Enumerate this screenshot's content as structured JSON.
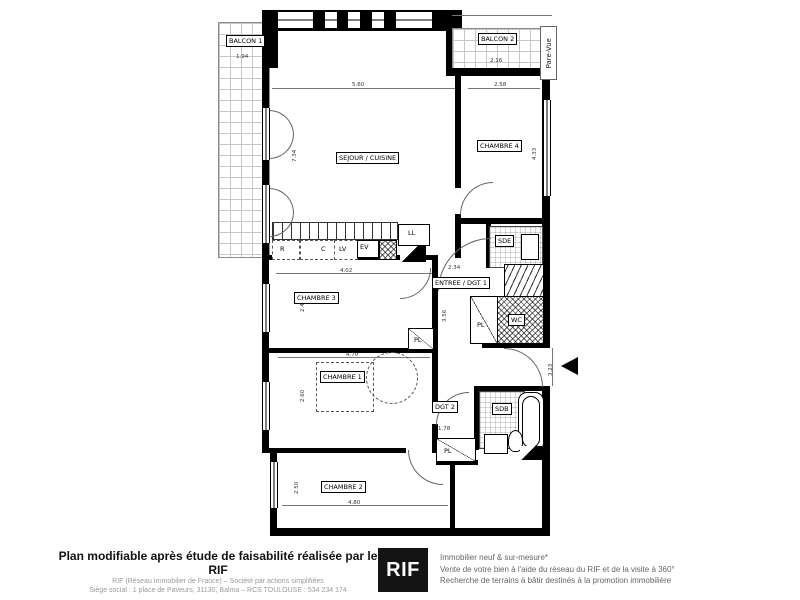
{
  "colors": {
    "wall": "#000000",
    "logo_bg": "#141414",
    "logo_text": "#ffffff",
    "muted_text": "#9a9a9a"
  },
  "plan": {
    "rooms": {
      "balcon1": {
        "label": "BALCON 1",
        "width_dim": "1.94"
      },
      "balcon2": {
        "label": "BALCON 2",
        "width_dim": "2.16",
        "screen_label": "Pare-Vue"
      },
      "sejour": {
        "label": "SEJOUR / CUISINE",
        "width_dim": "5.60",
        "height_dim": "7.34"
      },
      "chambre4": {
        "label": "CHAMBRE 4",
        "width_dim": "2.58",
        "height_dim": "4.33"
      },
      "entree": {
        "label": "ENTREE / DGT 1",
        "width_dim": "2.34",
        "height_dim": "3.56"
      },
      "chambre3": {
        "label": "CHAMBRE 3",
        "height_dim": "2.48"
      },
      "chambre1": {
        "label": "CHAMBRE 1",
        "width_dim": "4.70",
        "height_dim": "2.60"
      },
      "chambre2": {
        "label": "CHAMBRE 2",
        "width_dim": "4.80",
        "height_dim": "2.50"
      },
      "dgt2": {
        "label": "DGT 2",
        "width_dim": "1.78"
      },
      "sde": {
        "label": "SDE"
      },
      "wc": {
        "label": "WC"
      },
      "sdb": {
        "label": "SDB"
      }
    },
    "kitchen": {
      "r": "R",
      "c": "C",
      "lv": "LV",
      "ev": "EV",
      "ll": "LL",
      "width_dim": "4.02"
    },
    "closet_label": "PL",
    "entry_dim": "3.23"
  },
  "footer": {
    "left": {
      "title": "Plan modifiable après étude de faisabilité réalisée par le RIF",
      "line2": "RIF (Réseau Immobilier de France) – Société par actions simplifiées",
      "line3": "Siège social : 1 place de Paveurs, 31130, Balma – RCS TOULOUSE : 534 234 174"
    },
    "logo": "RIF",
    "right": {
      "line1": "Immobilier neuf & sur-mesure*",
      "line2": "Vente de votre bien à l'aide du réseau du RIF et de la visite à 360°",
      "line3": "Recherche de terrains à bâtir destinés à la promotion immobilière"
    }
  }
}
